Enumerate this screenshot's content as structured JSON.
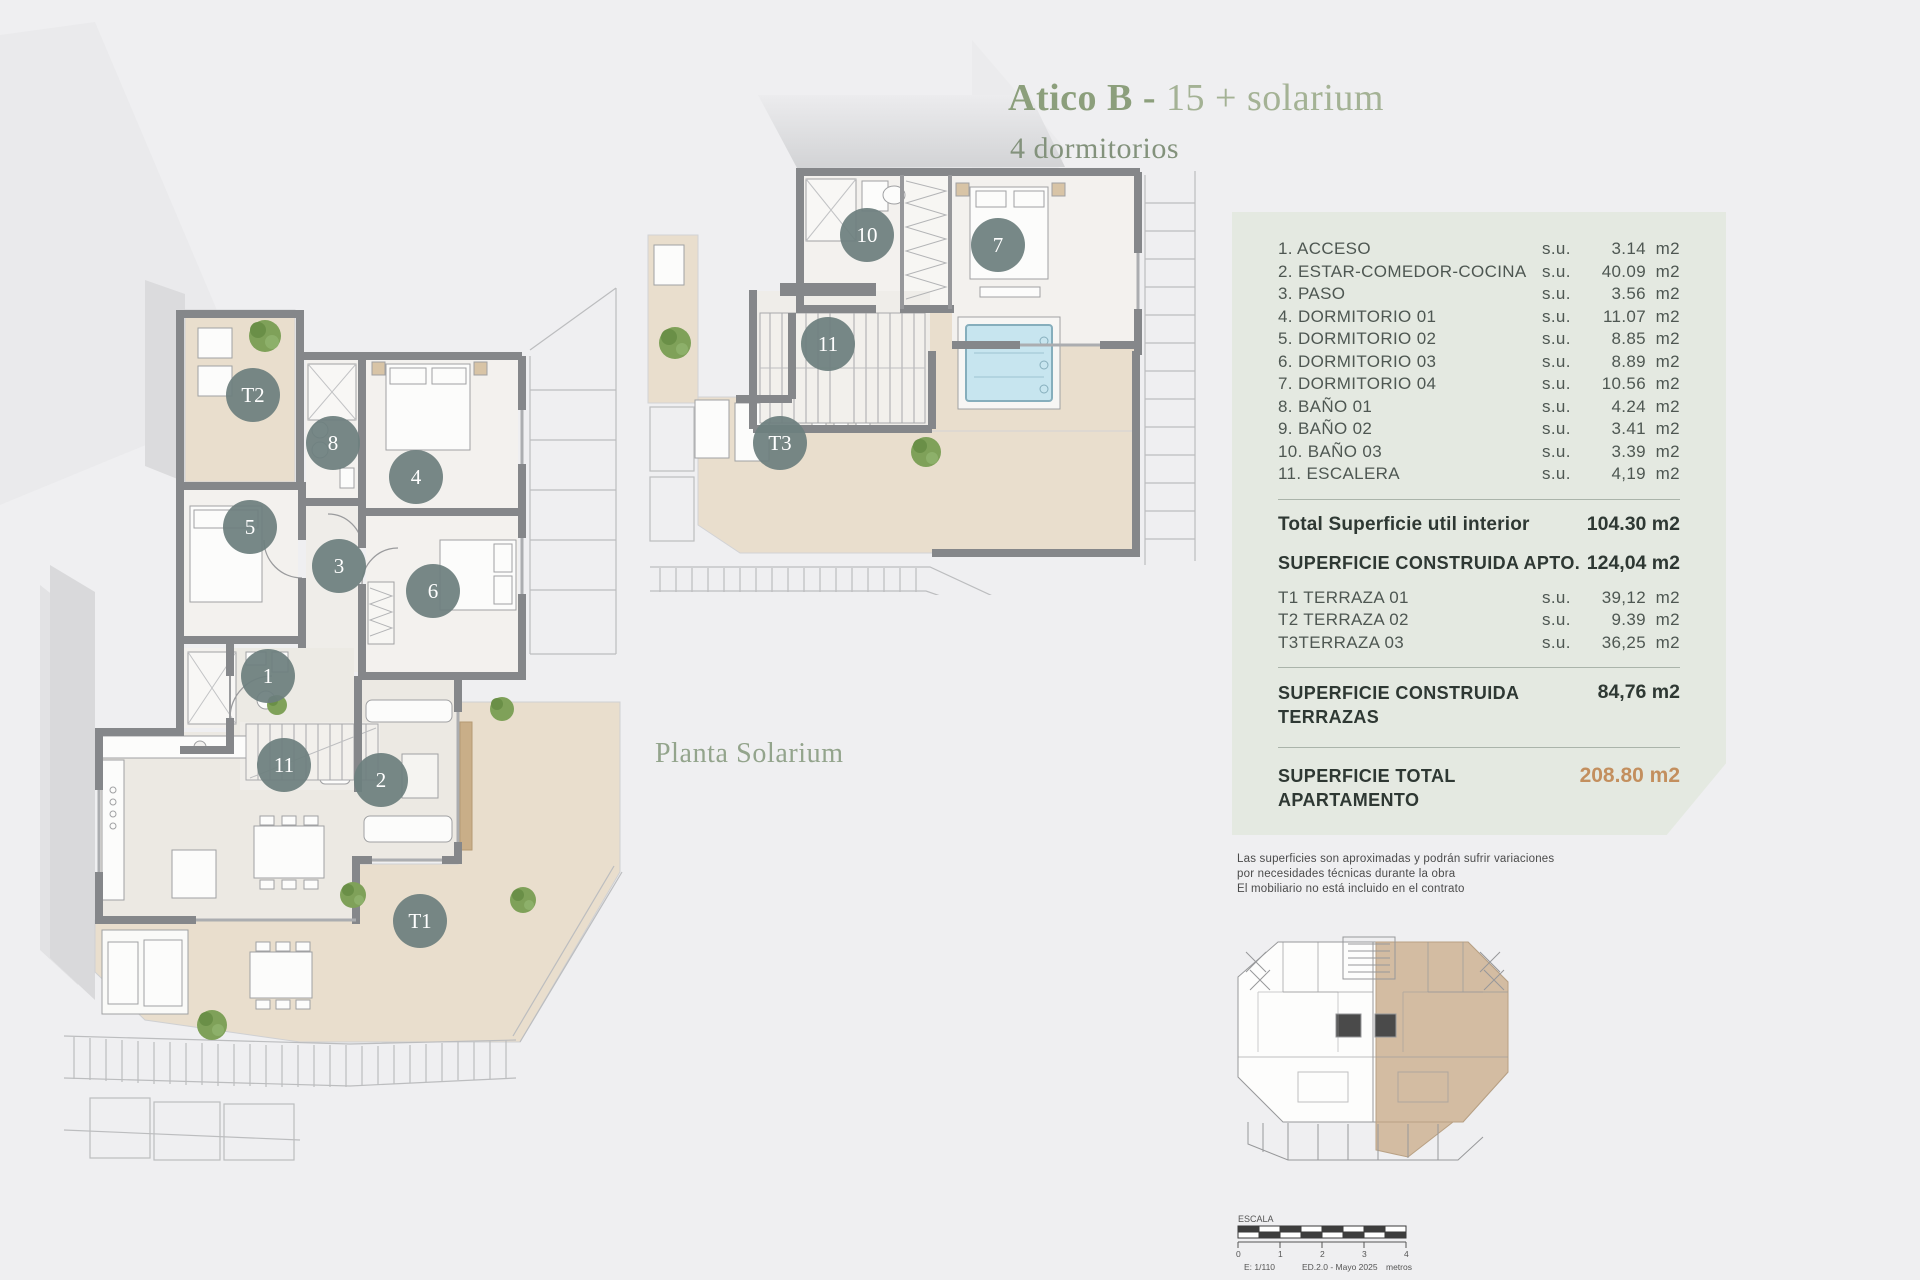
{
  "colors": {
    "page_bg": "#efeff1",
    "panel_bg": "#e4e9e1",
    "accent_orange": "#c38f5e",
    "title_green": "#8c9f7c",
    "wall_gray": "#85878a",
    "terrace_beige": "#e9decd",
    "pool_blue": "#c7e5ef",
    "marker_circle": "#6d7f7e",
    "keyplan_highlight": "#d3bca2"
  },
  "header": {
    "title_bold": "Atico B -",
    "title_light": "15 + solarium",
    "subtitle": "4 dormitorios"
  },
  "captions": {
    "solarium": "Planta Solarium"
  },
  "panel": {
    "rooms": [
      {
        "label": "1. ACCESO",
        "su": "s.u.",
        "value": "3.14",
        "unit": "m2"
      },
      {
        "label": "2. ESTAR-COMEDOR-COCINA",
        "su": "s.u.",
        "value": "40.09",
        "unit": "m2"
      },
      {
        "label": "3. PASO",
        "su": "s.u.",
        "value": "3.56",
        "unit": "m2"
      },
      {
        "label": "4. DORMITORIO 01",
        "su": "s.u.",
        "value": "11.07",
        "unit": "m2"
      },
      {
        "label": "5. DORMITORIO 02",
        "su": "s.u.",
        "value": "8.85",
        "unit": "m2"
      },
      {
        "label": "6. DORMITORIO 03",
        "su": "s.u.",
        "value": "8.89",
        "unit": "m2"
      },
      {
        "label": "7. DORMITORIO 04",
        "su": "s.u.",
        "value": "10.56",
        "unit": "m2"
      },
      {
        "label": "8. BAÑO 01",
        "su": "s.u.",
        "value": "4.24",
        "unit": "m2"
      },
      {
        "label": "9. BAÑO 02",
        "su": "s.u.",
        "value": "3.41",
        "unit": "m2"
      },
      {
        "label": "10. BAÑO 03",
        "su": "s.u.",
        "value": "3.39",
        "unit": "m2"
      },
      {
        "label": "11. ESCALERA",
        "su": "s.u.",
        "value": "4,19",
        "unit": "m2"
      }
    ],
    "total_interior": {
      "label": "Total Superficie util interior",
      "value": "104.30 m2"
    },
    "construida_apto": {
      "label": "SUPERFICIE CONSTRUIDA APTO.",
      "value": "124,04 m2"
    },
    "terraces": [
      {
        "label": "T1 TERRAZA 01",
        "su": "s.u.",
        "value": "39,12",
        "unit": "m2"
      },
      {
        "label": "T2 TERRAZA 02",
        "su": "s.u.",
        "value": "9.39",
        "unit": "m2"
      },
      {
        "label": "T3TERRAZA 03",
        "su": "s.u.",
        "value": "36,25",
        "unit": "m2"
      }
    ],
    "construida_terrazas": {
      "label_line1": "SUPERFICIE CONSTRUIDA",
      "label_line2": "TERRAZAS",
      "value": "84,76 m2"
    },
    "total_apartamento": {
      "label_line1": "SUPERFICIE TOTAL",
      "label_line2": "APARTAMENTO",
      "value": "208.80 m2"
    }
  },
  "disclaimer": {
    "line1": "Las superficies son aproximadas y podrán sufrir variaciones",
    "line2": "por necesidades técnicas durante la obra",
    "line3": "El mobiliario no está incluido en el contrato"
  },
  "main_plan": {
    "markers": [
      {
        "label": "T2"
      },
      {
        "label": "8"
      },
      {
        "label": "4"
      },
      {
        "label": "5"
      },
      {
        "label": "3"
      },
      {
        "label": "6"
      },
      {
        "label": "1"
      },
      {
        "label": "11"
      },
      {
        "label": "2"
      },
      {
        "label": "T1"
      }
    ]
  },
  "solarium_plan": {
    "markers": [
      {
        "label": "10"
      },
      {
        "label": "7"
      },
      {
        "label": "11"
      },
      {
        "label": "T3"
      }
    ]
  },
  "scalebar": {
    "title": "ESCALA",
    "ticks": [
      "0",
      "1",
      "2",
      "3",
      "4"
    ],
    "scale": "E: 1/110",
    "edition": "ED.2.0 - Mayo 2025",
    "units": "metros"
  }
}
